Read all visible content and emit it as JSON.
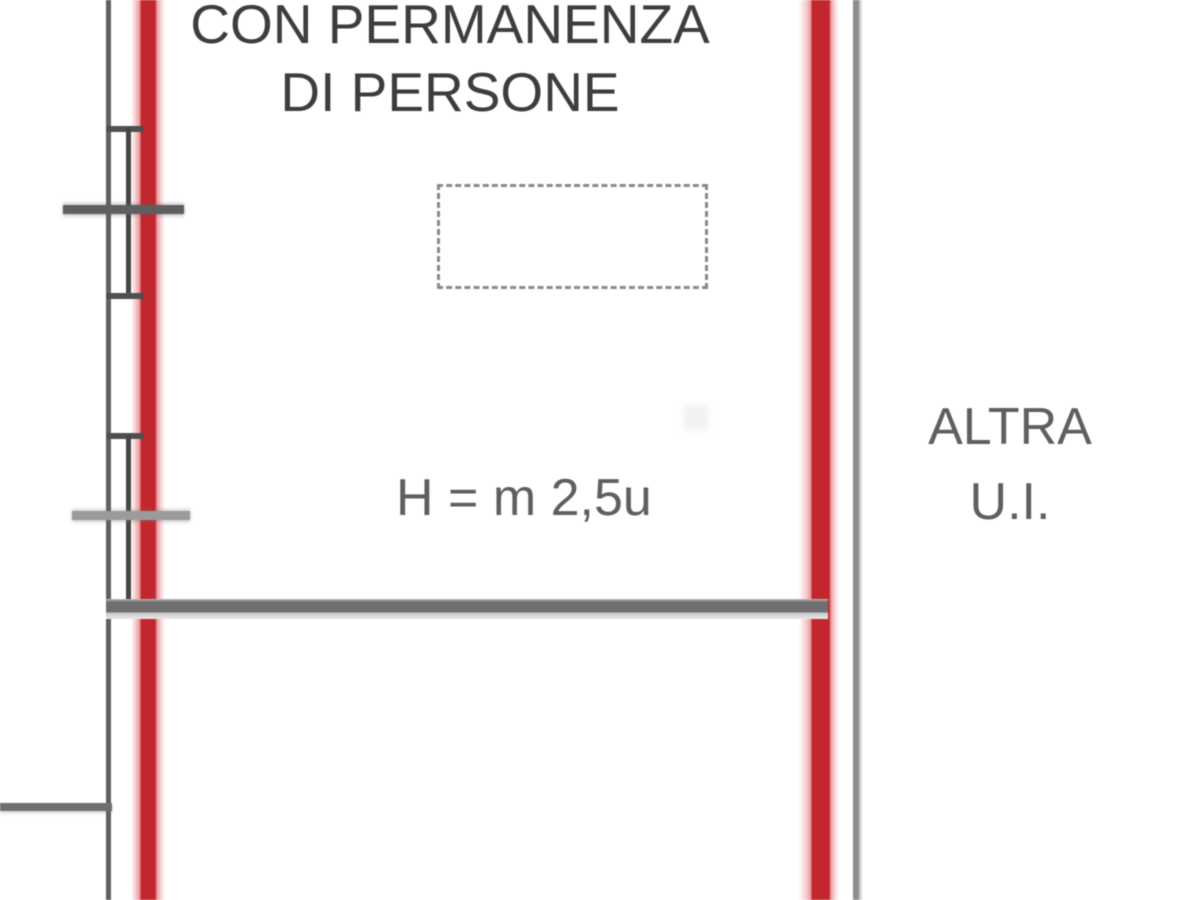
{
  "drawing": {
    "labels": {
      "room_line1": "CON PERMANENZA",
      "room_line2": "DI PERSONE",
      "height_annotation": "H = m 2,5u",
      "adjacent_line1": "ALTRA",
      "adjacent_line2": "U.I."
    },
    "colors": {
      "unit_boundary_red": "#c1272d",
      "boundary_fringe_pink": "#f1aeb0",
      "outer_wall_gray": "#606060",
      "partition_wall_gray": "#8d8d8d",
      "floor_line_gray": "#6f6f6f",
      "floor_line_shadow": "#c9c9c9",
      "window_line_gray": "#464646",
      "sill_gray": "#4f4f4f",
      "tick_dark_gray": "#5f5f5f",
      "tick_light_gray": "#9b9b9b",
      "dashed_box_gray": "#8a8a8a",
      "label_dark": "#3d3d3d",
      "label_gray": "#5f5f5f",
      "background": "#ffffff"
    }
  }
}
